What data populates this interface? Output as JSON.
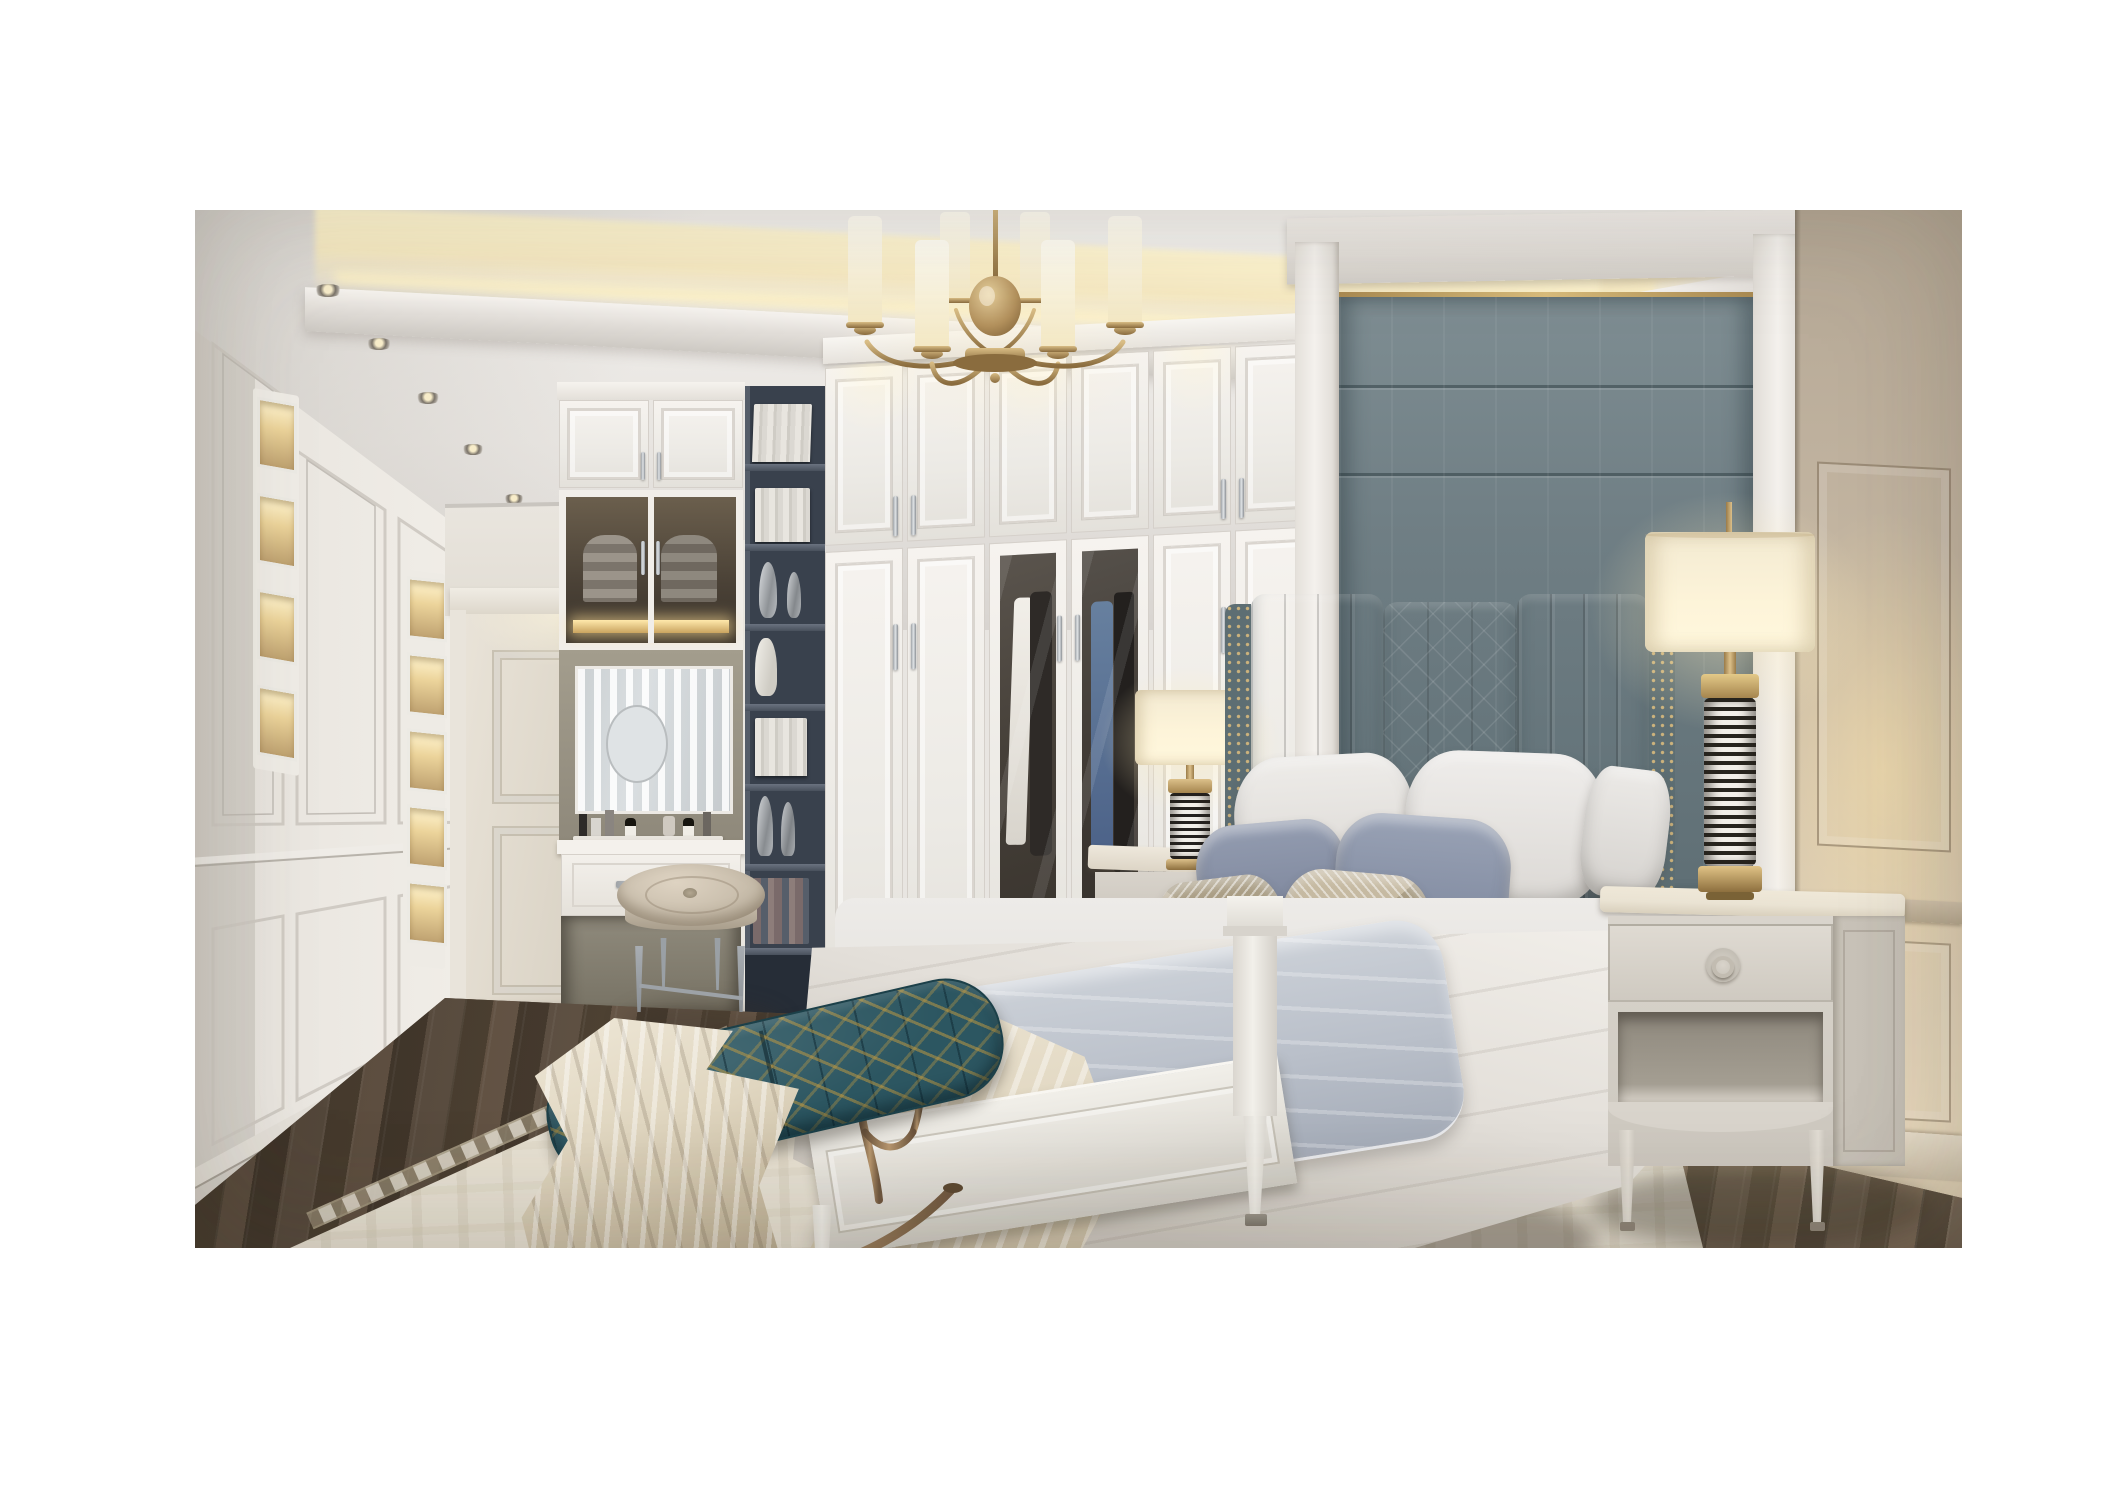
{
  "meta": {
    "description": "3D render of a classic luxury bedroom: white built-in wardrobe wall, gray upholstered bed wall with channel-tufted headboard, brass chandelier with white cylinder shades, vanity nook with mirror, dark open shelving tower, cream nightstands with black-and-white striped brass lamps, teal-and-gold bench, cream ornamental rug on dark walnut floor, hallway with panelled walls and door on the left"
  },
  "palette": {
    "page_bg": "#ffffff",
    "ceiling_hi": "#f3f1ee",
    "ceiling": "#e8e5e1",
    "ceiling_shade": "#d8d4d0",
    "cove_glow": "#f6e9c2",
    "cove_core": "#fff6d2",
    "wall_left_near": "#e5e1db",
    "wall_left_far": "#f1eee9",
    "door_face": "#e7e1d5",
    "wardrobe_face": "#f4f1ed",
    "wardrobe_line": "#d5d0ca",
    "glass_dark": "#46403a",
    "shirt_white": "#eeebe4",
    "shirt_blue": "#5a739c",
    "suit_dark": "#2e2a27",
    "shelf_bg": "#39414d",
    "shelf_board": "#5b6370",
    "book_light": "#e8e5df",
    "vase_silver": "#c7cacd",
    "panel_gray_hi": "#7e8d92",
    "panel_gray_lo": "#5f6f75",
    "gold_trim": "#cfae6c",
    "pilaster": "#f0ede9",
    "wall_right_hi": "#e7d8bc",
    "wall_right_lo": "#b4a795",
    "headboard_hi": "#75848a",
    "headboard_lo": "#5c6c71",
    "nailhead": "#c6ab74",
    "pillow_white": "#e9e7e4",
    "pillow_blue": "#8a93a8",
    "pillow_tan": "#b9ac94",
    "mattress": "#e9e7e4",
    "duvet_hi": "#f0ede8",
    "duvet_lo": "#cdc8c0",
    "quilt_gray": "#c3c8d1",
    "throw_hi": "#ece4d2",
    "throw_lo": "#a3947a",
    "bedframe": "#eeece6",
    "nightstand_face": "#d9d4cc",
    "nightstand_side": "#c5bfb5",
    "nightstand_top": "#eae3d3",
    "lamp_shade_hi": "#fdf4d9",
    "lamp_shade_lo": "#f0e6c8",
    "brass_hi": "#dcc08a",
    "brass_lo": "#9a7b48",
    "stripe_dark": "#28251f",
    "bench_teal": "#2c5661",
    "bench_gold": "#c79d40",
    "bronze_hi": "#b9986f",
    "bronze_lo": "#6f573f",
    "stool_leather": "#d6cbba",
    "rug_base": "#e7e1d3",
    "rug_motif": "#cec4aa",
    "floor_a": "#6b5c4d",
    "floor_b": "#564939",
    "floor_c": "#746251",
    "floor_d": "#4d4134"
  },
  "scene": {
    "chandelier": {
      "label": "brass chandelier",
      "visible_shades": 6
    },
    "ceiling": {
      "label": "tray ceiling with warm cove lighting",
      "hallway_spotlights": 7,
      "soffit_spotlights": 4
    },
    "hallway": {
      "label": "panelled hallway with door",
      "lighted_niche_columns": 2
    },
    "wardrobe": {
      "label": "white built-in wardrobe",
      "upper_doors": 6,
      "lower_doors": 6,
      "glass_doors": 2
    },
    "vanity": {
      "label": "built-in vanity with mirror",
      "figurines": 2,
      "perfume_bottles": 5
    },
    "bookshelf": {
      "label": "dark open shelving tower",
      "shelves": 7
    },
    "bed": {
      "label": "upholstered bed",
      "back_pillows": 3,
      "blue_pillows": 2,
      "accent_pillows": 2
    },
    "nightstands": {
      "label": "cream nightstands",
      "count": 2
    },
    "lamps": {
      "label": "striped table lamps with brass accents",
      "count": 2
    },
    "bench": {
      "label": "teal and gold bench with bronze frame"
    },
    "stool": {
      "label": "round leather vanity stool"
    },
    "rug": {
      "label": "cream ornamental rug"
    },
    "floor": {
      "label": "dark walnut plank floor"
    }
  }
}
